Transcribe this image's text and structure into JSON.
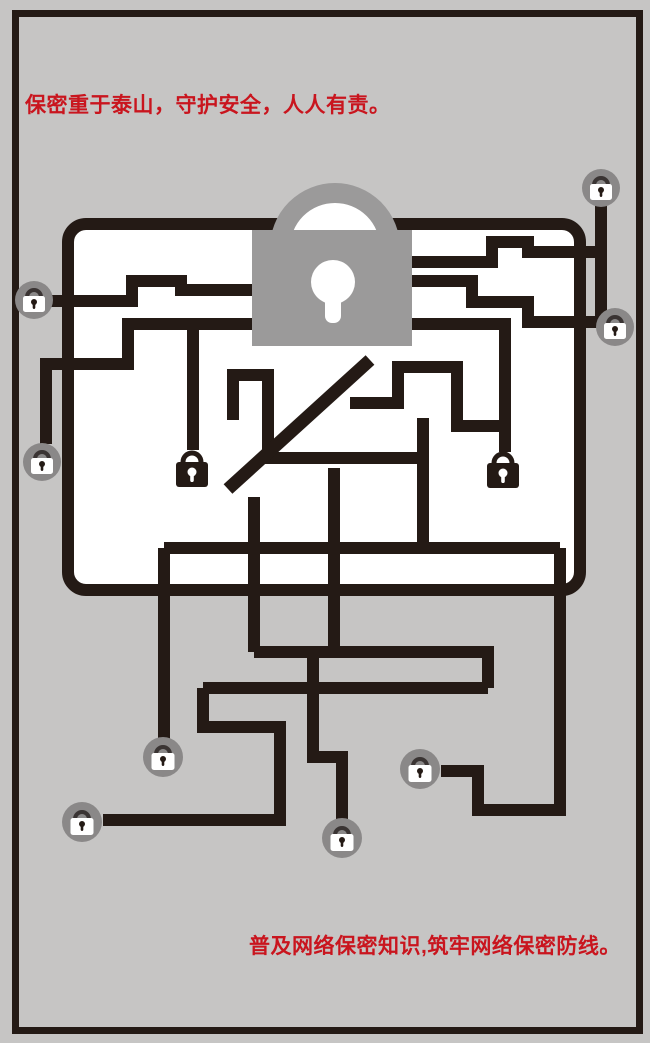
{
  "poster": {
    "top_slogan": "保密重于泰山，守护安全，人人有责。",
    "bottom_slogan": "普及网络保密知识,筑牢网络保密防线。"
  },
  "colors": {
    "background": "#c6c5c4",
    "line": "#241a15",
    "slogan_red": "#c9151e",
    "lock_gray": "#9b9a9a",
    "badge_gray": "#8a8888",
    "panel_white": "#ffffff"
  },
  "icons": {
    "center_icon": "large-padlock-icon",
    "endpoint_icon": "circled-padlock-icon",
    "hanging_icon": "dark-padlock-icon",
    "strike": "diagonal-slash"
  }
}
